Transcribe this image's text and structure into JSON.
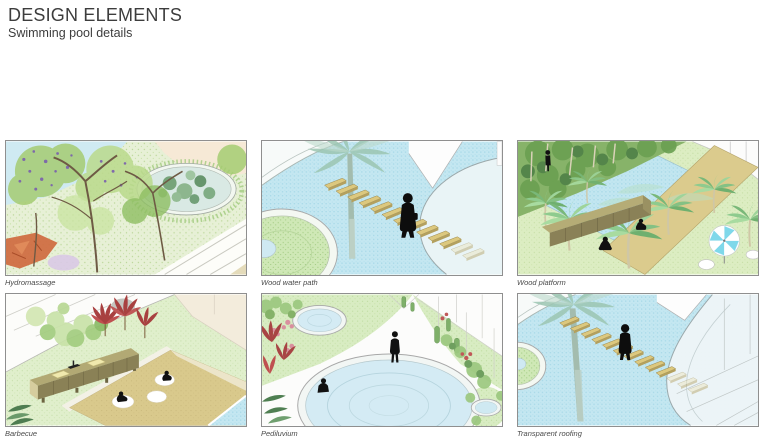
{
  "header": {
    "title": "DESIGN ELEMENTS",
    "subtitle": "Swimming pool details"
  },
  "panels": [
    {
      "id": "hydromassage",
      "caption": "Hydromassage"
    },
    {
      "id": "wood-water-path",
      "caption": "Wood water path"
    },
    {
      "id": "wood-platform",
      "caption": "Wood platform"
    },
    {
      "id": "barbecue",
      "caption": "Barbecue"
    },
    {
      "id": "pediluvium",
      "caption": "Pediluvium"
    },
    {
      "id": "transparent-roofing",
      "caption": "Transparent roofing"
    }
  ],
  "palette": {
    "pool_blue": "#c4e7f1",
    "lawn_green": "#dcedc2",
    "wood_tan": "#dcc87e",
    "deck_tan": "#d9c98c",
    "foliage_green": "#a5cc72",
    "flower_purple": "#7a5fae",
    "cordyline_red": "#a84444",
    "umbrella_blue": "#7fd8ea",
    "silhouette_black": "#111111",
    "frame_gray": "#8f8f8f",
    "title_gray": "#3d3d3d",
    "caption_gray": "#4a4a4a"
  }
}
